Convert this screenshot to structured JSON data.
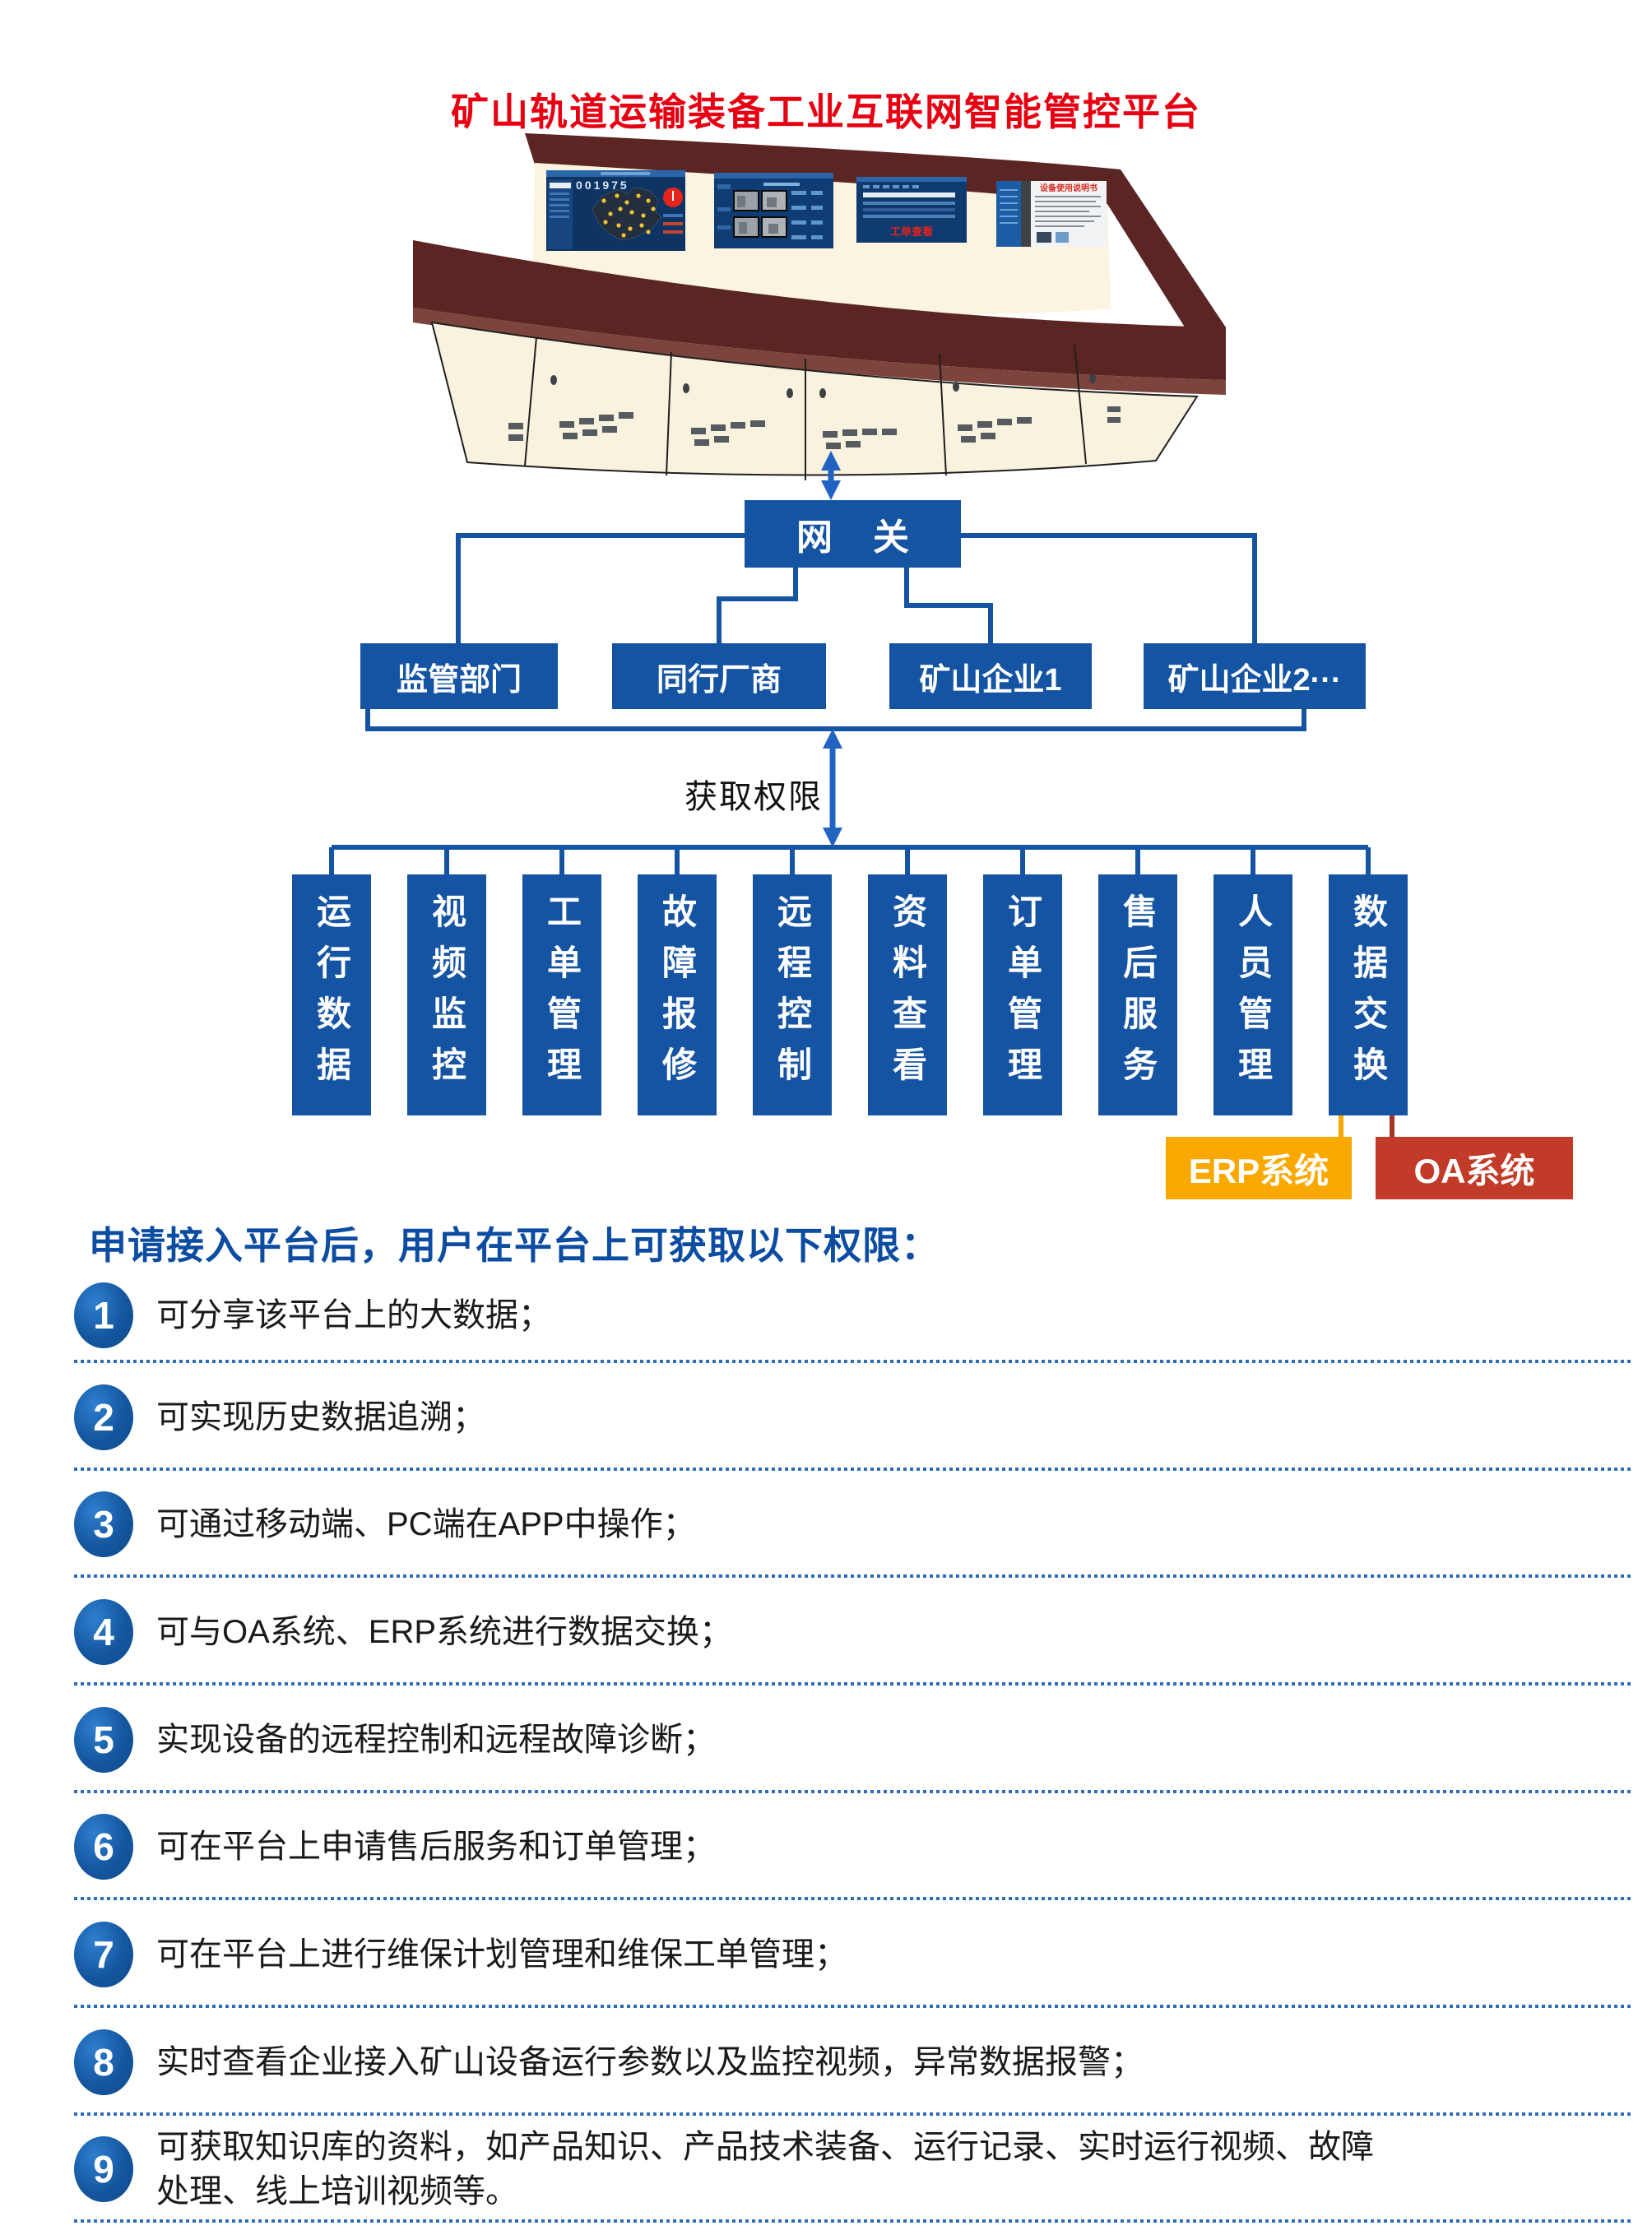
{
  "title": "矿山轨道运输装备工业互联网智能管控平台",
  "console": {
    "screen1_number": "001975",
    "screen3_label": "工单查看",
    "screen4_title": "设备使用说明书"
  },
  "flow": {
    "gateway_label": "网    关",
    "orgs": [
      "监管部门",
      "同行厂商",
      "矿山企业1",
      "矿山企业2···"
    ],
    "permission_label": "获取权限",
    "modules": [
      "运行数据",
      "视频监控",
      "工单管理",
      "故障报修",
      "远程控制",
      "资料查看",
      "订单管理",
      "售后服务",
      "人员管理",
      "数据交换"
    ],
    "erp_label": "ERP系统",
    "oa_label": "OA系统"
  },
  "permissions": {
    "heading": "申请接入平台后，用户在平台上可获取以下权限：",
    "items": [
      {
        "num": "1",
        "text": "可分享该平台上的大数据；"
      },
      {
        "num": "2",
        "text": "可实现历史数据追溯；"
      },
      {
        "num": "3",
        "text": "可通过移动端、PC端在APP中操作；"
      },
      {
        "num": "4",
        "text": "可与OA系统、ERP系统进行数据交换；"
      },
      {
        "num": "5",
        "text": "实现设备的远程控制和远程故障诊断；"
      },
      {
        "num": "6",
        "text": "可在平台上申请售后服务和订单管理；"
      },
      {
        "num": "7",
        "text": "可在平台上进行维保计划管理和维保工单管理；"
      },
      {
        "num": "8",
        "text": "实时查看企业接入矿山设备运行参数以及监控视频，异常数据报警；"
      },
      {
        "num": "9",
        "text": "可获取知识库的资料，如产品知识、产品技术装备、运行记录、实时运行视频、故障处理、线上培训视频等。"
      }
    ]
  },
  "colors": {
    "title_red": "#E60012",
    "flow_blue": "#1554A2",
    "arrow_blue": "#2063C0",
    "erp_orange": "#F9A800",
    "oa_red": "#C23A28",
    "heading_blue": "#0C4DA2",
    "separator_blue": "#2E6CB5"
  }
}
